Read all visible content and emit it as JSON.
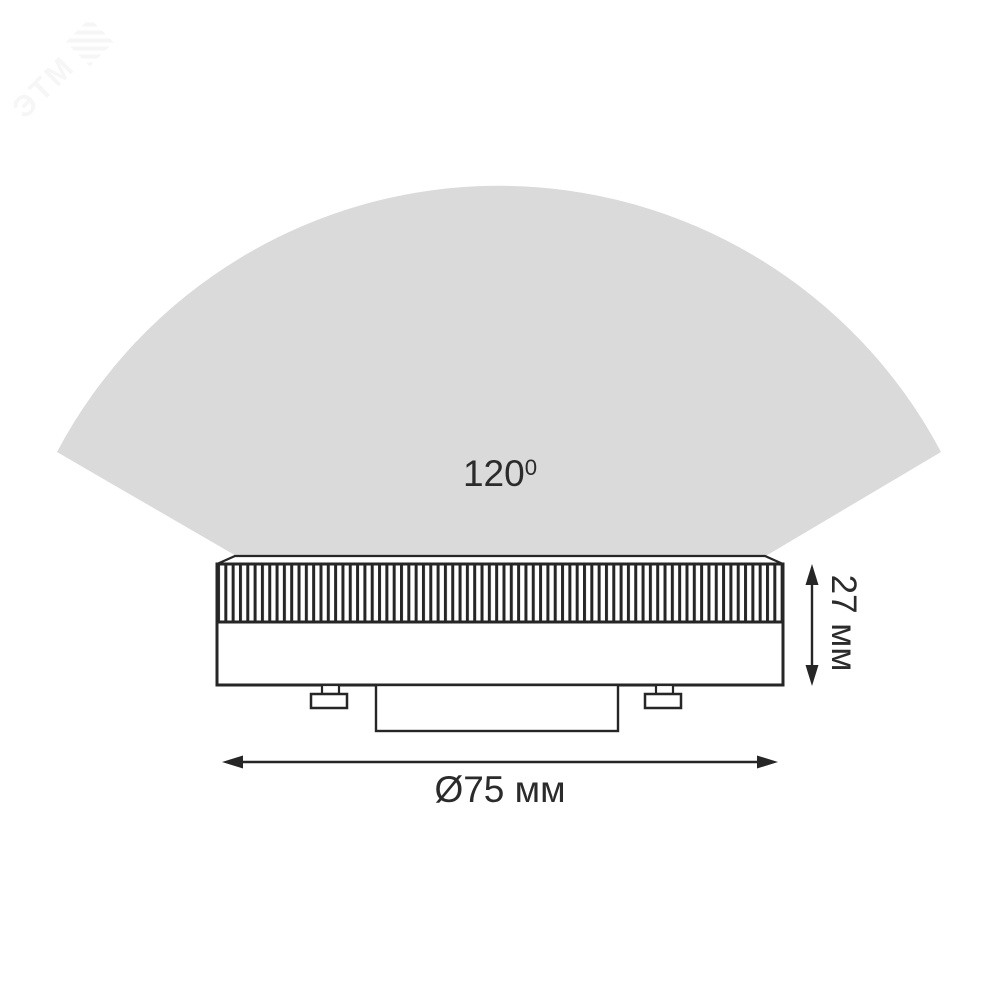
{
  "watermark": {
    "text": "ЭТМ"
  },
  "beam": {
    "angle_label_value": "120",
    "angle_label_sup": "0",
    "full_label": "120⁰",
    "angle_degrees": 120
  },
  "dimensions": {
    "height": "27 мм",
    "diameter": "Ø75 мм",
    "height_mm": 27,
    "diameter_mm": 75
  },
  "colors": {
    "background": "#ffffff",
    "beam_fill": "#dadada",
    "line": "#262626",
    "text": "#2b2b2b",
    "watermark": "#f6f6f6"
  }
}
